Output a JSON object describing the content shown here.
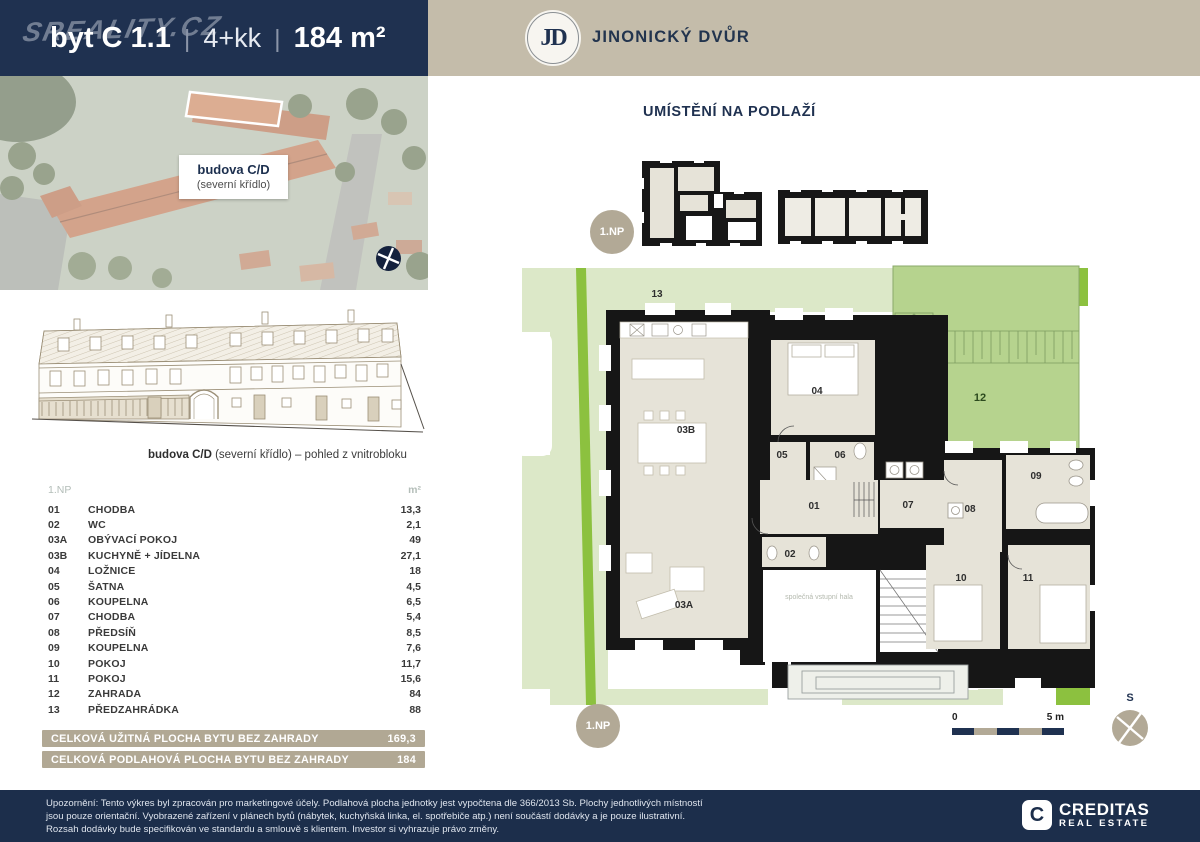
{
  "header": {
    "watermark": "SREALITY.CZ",
    "unit": "byt C 1.1",
    "separator": "|",
    "disposition": "4+kk",
    "area": "184 m²",
    "brand": {
      "initials": "JD",
      "name": "JINONICKÝ DVŮR"
    }
  },
  "photo_label": {
    "title": "budova C/D",
    "subtitle": "(severní křídlo)"
  },
  "elevation": {
    "caption_bold": "budova C/D",
    "caption_rest": " (severní křídlo) – pohled z vnitrobloku"
  },
  "room_table": {
    "floor_label": "1.NP",
    "unit_header": "m²",
    "rows": [
      {
        "no": "01",
        "name": "CHODBA",
        "area": "13,3"
      },
      {
        "no": "02",
        "name": "WC",
        "area": "2,1"
      },
      {
        "no": "03A",
        "name": "OBÝVACÍ POKOJ",
        "area": "49"
      },
      {
        "no": "03B",
        "name": "KUCHYNĚ + JÍDELNA",
        "area": "27,1"
      },
      {
        "no": "04",
        "name": "LOŽNICE",
        "area": "18"
      },
      {
        "no": "05",
        "name": "ŠATNA",
        "area": "4,5"
      },
      {
        "no": "06",
        "name": "KOUPELNA",
        "area": "6,5"
      },
      {
        "no": "07",
        "name": "CHODBA",
        "area": "5,4"
      },
      {
        "no": "08",
        "name": "PŘEDSÍŇ",
        "area": "8,5"
      },
      {
        "no": "09",
        "name": "KOUPELNA",
        "area": "7,6"
      },
      {
        "no": "10",
        "name": "POKOJ",
        "area": "11,7"
      },
      {
        "no": "11",
        "name": "POKOJ",
        "area": "15,6"
      },
      {
        "no": "12",
        "name": "ZAHRADA",
        "area": "84"
      },
      {
        "no": "13",
        "name": "PŘEDZAHRÁDKA",
        "area": "88"
      }
    ],
    "totals": [
      {
        "label": "CELKOVÁ UŽITNÁ PLOCHA BYTU BEZ ZAHRADY",
        "value": "169,3"
      },
      {
        "label": "CELKOVÁ PODLAHOVÁ PLOCHA BYTU BEZ ZAHRADY",
        "value": "184"
      }
    ]
  },
  "plan": {
    "heading": "UMÍSTĚNÍ NA PODLAŽÍ",
    "floor_badge": "1.NP",
    "labels": {
      "r01": "01",
      "r02": "02",
      "r03a": "03A",
      "r03b": "03B",
      "r04": "04",
      "r05": "05",
      "r06": "06",
      "r07": "07",
      "r08": "08",
      "r09": "09",
      "r10": "10",
      "r11": "11",
      "r12": "12",
      "r13": "13",
      "hall": "společná vstupní hala"
    },
    "scale_start": "0",
    "scale_end": "5 m",
    "compass": "S"
  },
  "footer": {
    "lines": [
      "Upozornění: Tento výkres byl zpracován pro marketingové účely. Podlahová plocha jednotky jest vypočtena dle 366/2013 Sb. Plochy jednotlivých místností",
      "jsou pouze orientační. Vyobrazené zařízení v plánech bytů (nábytek, kuchyňská linka, el. spotřebiče atp.) není součástí dodávky a je pouze ilustrativní.",
      "Rozsah dodávky bude specifikován ve standardu a smlouvě s klientem. Investor si vyhrazuje právo změny."
    ],
    "logo": {
      "letter": "C",
      "title": "CREDITAS",
      "subtitle": "REAL ESTATE"
    }
  },
  "colors": {
    "navy": "#1f3150",
    "header_beige": "#c4bcaa",
    "taupe": "#b2a996",
    "pale_green": "#dce8c8",
    "garden_green": "#b6d38e",
    "accent_green": "#8cc13f",
    "room_fill": "#e6e3d8",
    "wall": "#161616"
  }
}
